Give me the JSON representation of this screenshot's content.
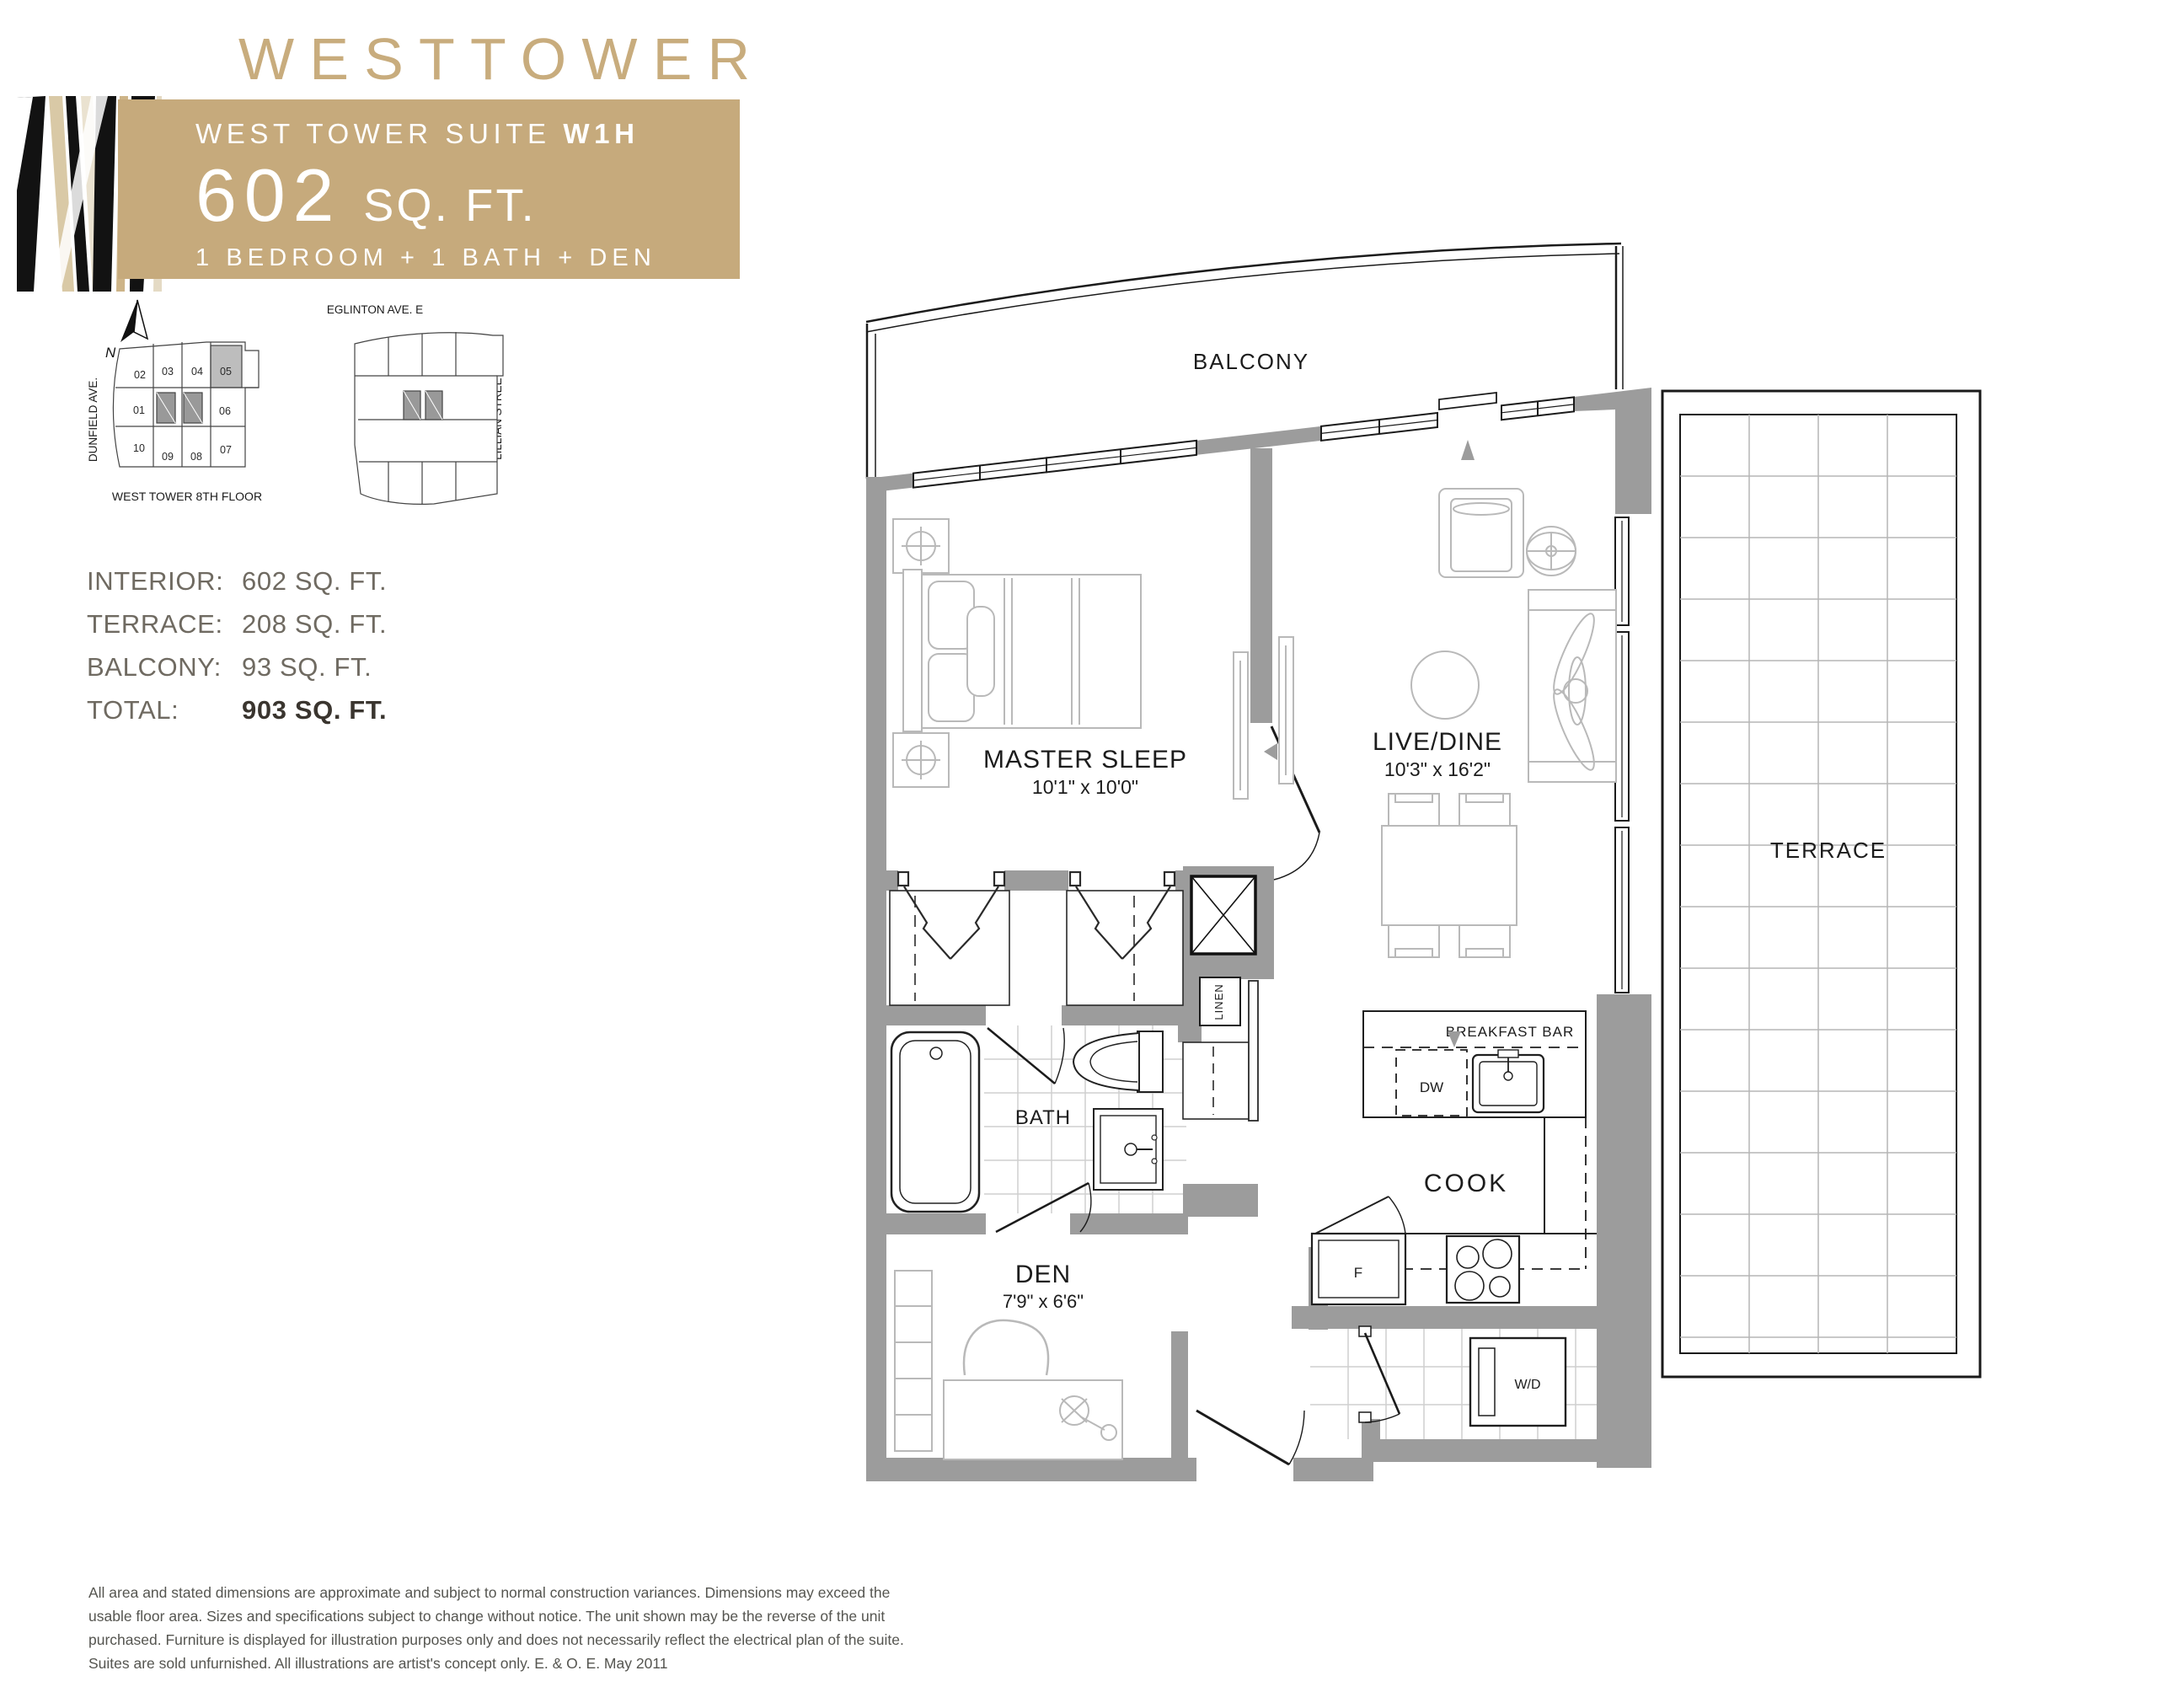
{
  "header": {
    "brand": "WESTTOWER",
    "suite_label": "WEST TOWER SUITE ",
    "suite_code": "W1H",
    "area_number": "602",
    "area_unit": "SQ. FT.",
    "configuration": "1 BEDROOM + 1 BATH + DEN"
  },
  "colors": {
    "accent_tan": "#c6aa7c",
    "wall_gray": "#9c9c9c",
    "keyplan_highlight": "#bdbdbd"
  },
  "keyplan": {
    "street_top": "EGLINTON AVE. E",
    "street_left": "DUNFIELD AVE.",
    "street_right": "LILLIAN STREET",
    "caption": "WEST TOWER  8TH FLOOR",
    "north_label": "N",
    "highlighted_unit": "05",
    "units": [
      "01",
      "02",
      "03",
      "04",
      "05",
      "06",
      "07",
      "08",
      "09",
      "10"
    ]
  },
  "areas": {
    "rows": [
      {
        "label": "INTERIOR:",
        "value": "602 SQ. FT."
      },
      {
        "label": "TERRACE:",
        "value": "208 SQ. FT."
      },
      {
        "label": "BALCONY:",
        "value": "93 SQ. FT."
      },
      {
        "label": "TOTAL:",
        "value": "903 SQ. FT."
      }
    ]
  },
  "plan": {
    "balcony": "BALCONY",
    "terrace": "TERRACE",
    "master": {
      "name": "MASTER SLEEP",
      "dims": "10'1\" x 10'0\""
    },
    "livedine": {
      "name": "LIVE/DINE",
      "dims": "10'3\" x 16'2\""
    },
    "den": {
      "name": "DEN",
      "dims": "7'9\" x 6'6\""
    },
    "bath": "BATH",
    "cook": "COOK",
    "breakfast_bar": "BREAKFAST BAR",
    "linen": "LINEN",
    "dishwasher": "DW",
    "fridge": "F",
    "washer_dryer": "W/D"
  },
  "disclaimer": "All area and stated dimensions are approximate and subject to normal construction variances. Dimensions may exceed the usable floor area. Sizes and specifications subject to change without notice. The unit shown may be the reverse of the unit purchased. Furniture is displayed for illustration purposes only and does not necessarily reflect the electrical plan of the suite. Suites are sold unfurnished. All illustrations are artist's concept only. E. & O. E. May 2011"
}
